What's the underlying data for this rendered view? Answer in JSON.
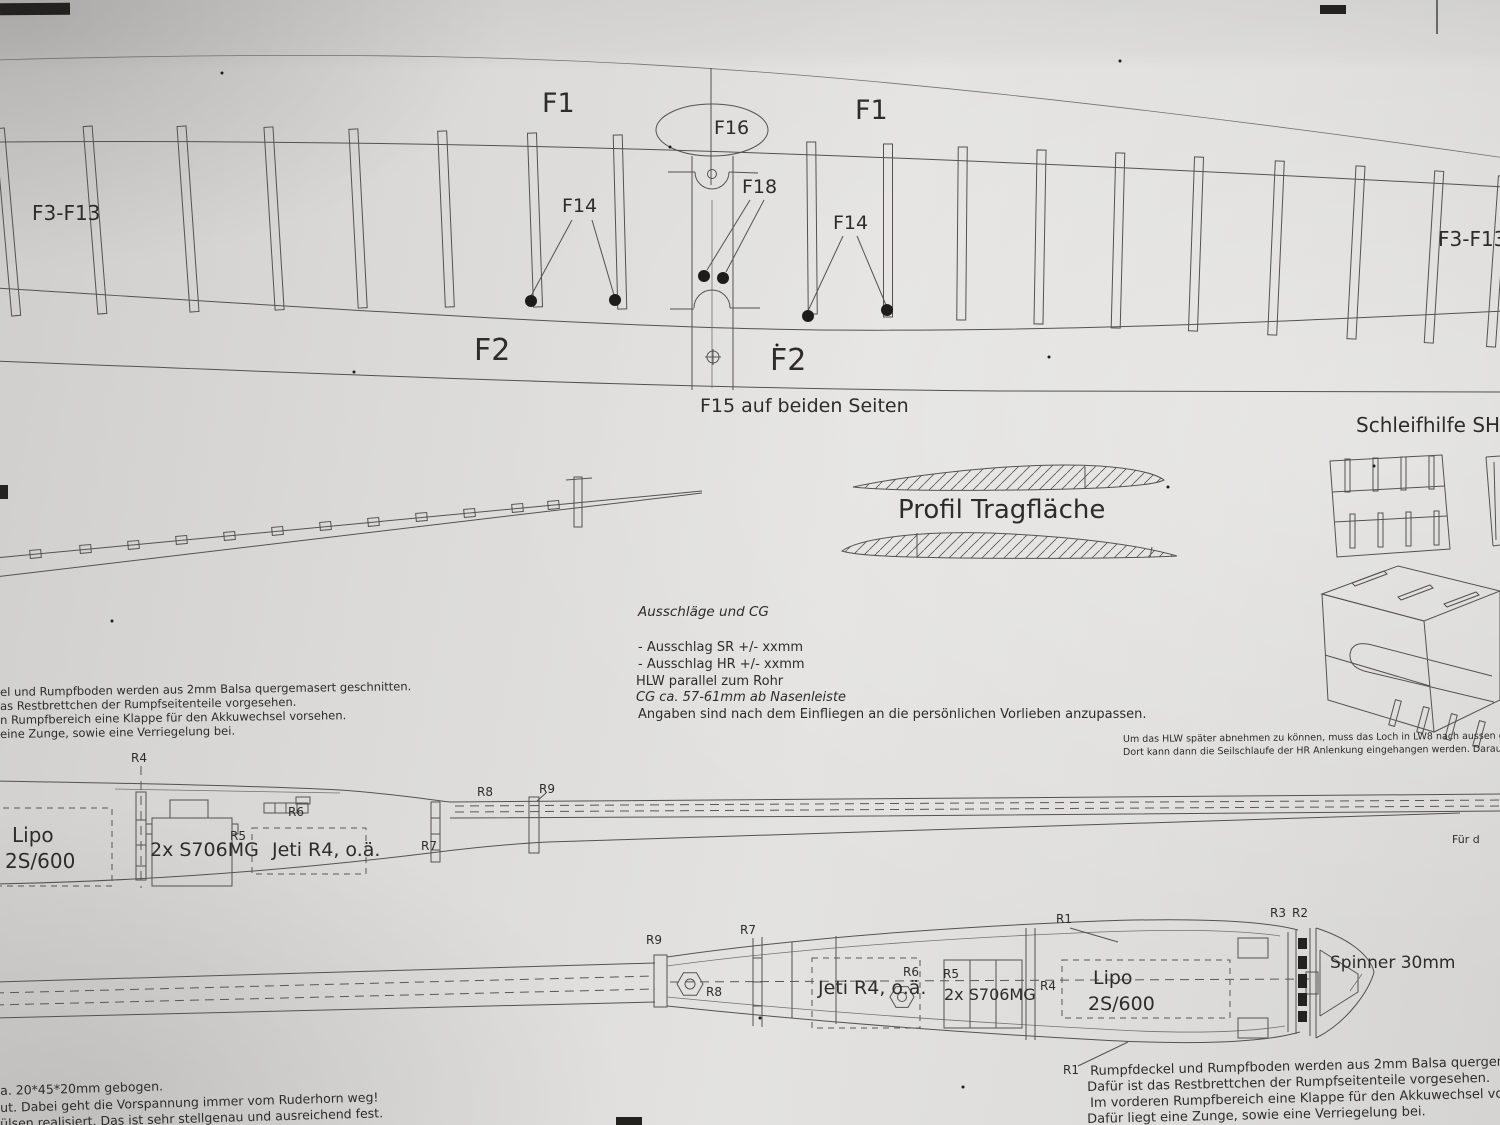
{
  "wing": {
    "f1": "F1",
    "f16": "F16",
    "f18": "F18",
    "f14": "F14",
    "f3_f13": "F3-F13",
    "f2": "F2",
    "f15_note": "F15 auf beiden Seiten"
  },
  "profile": {
    "title": "Profil Tragfläche"
  },
  "sanding_aid": {
    "title": "Schleifhilfe SH1"
  },
  "settings_block": {
    "title": "Ausschläge und CG",
    "lines": [
      "- Ausschlag SR +/- xxmm",
      "- Ausschlag HR +/- xxmm",
      "HLW parallel zum Rohr",
      "CG ca. 57-61mm ab Nasenleiste",
      "Angaben sind nach dem Einfliegen an die persönlichen Vorlieben anzupassen."
    ]
  },
  "left_note": {
    "lines": [
      "el und Rumpfboden werden aus 2mm Balsa quergemasert geschnitten.",
      "as Restbrettchen der Rumpfseitenteile vorgesehen.",
      "n Rumpfbereich eine Klappe für den Akkuwechsel vorsehen.",
      "eine Zunge, sowie eine Verriegelung bei."
    ]
  },
  "hlw_note": {
    "lines": [
      "Um das HLW später abnehmen zu können, muss das Loch in LW8 nach aussen geschlitzt werden.",
      "Dort kann dann die Seilschlaufe der HR Anlenkung eingehangen werden. Darauf achten, dass die"
    ]
  },
  "side_view": {
    "r4": "R4",
    "r5": "R5",
    "r6": "R6",
    "r7": "R7",
    "r8": "R8",
    "r9": "R9",
    "lipo_1": "Lipo",
    "lipo_2": "2S/600",
    "servos": "2x S706MG",
    "receiver": "Jeti R4, o.ä."
  },
  "top_view": {
    "r1": "R1",
    "r2": "R2",
    "r3": "R3",
    "r4": "R4",
    "r5": "R5",
    "r6": "R6",
    "r7": "R7",
    "r8": "R8",
    "r9": "R9",
    "lipo_1": "Lipo",
    "lipo_2": "2S/600",
    "servos": "2x S706MG",
    "receiver": "Jeti R4, o.ä.",
    "spinner": "Spinner 30mm"
  },
  "right_note": {
    "lines": [
      "Rumpfdeckel und Rumpfboden werden aus 2mm Balsa quergemasert geschnitten.",
      "Dafür ist das Restbrettchen der Rumpfseitenteile vorgesehen.",
      "Im vorderen Rumpfbereich eine Klappe für den Akkuwechsel vorsehen.",
      "Dafür liegt eine Zunge, sowie eine Verriegelung bei."
    ]
  },
  "bend_note": {
    "lines": [
      "a. 20*45*20mm gebogen.",
      "ut. Dabei geht die Vorspannung immer vom Ruderhorn weg!",
      "ülsen realisiert. Das ist sehr stellgenau und ausreichend fest."
    ]
  },
  "fragment": {
    "fuer": "Für d"
  }
}
